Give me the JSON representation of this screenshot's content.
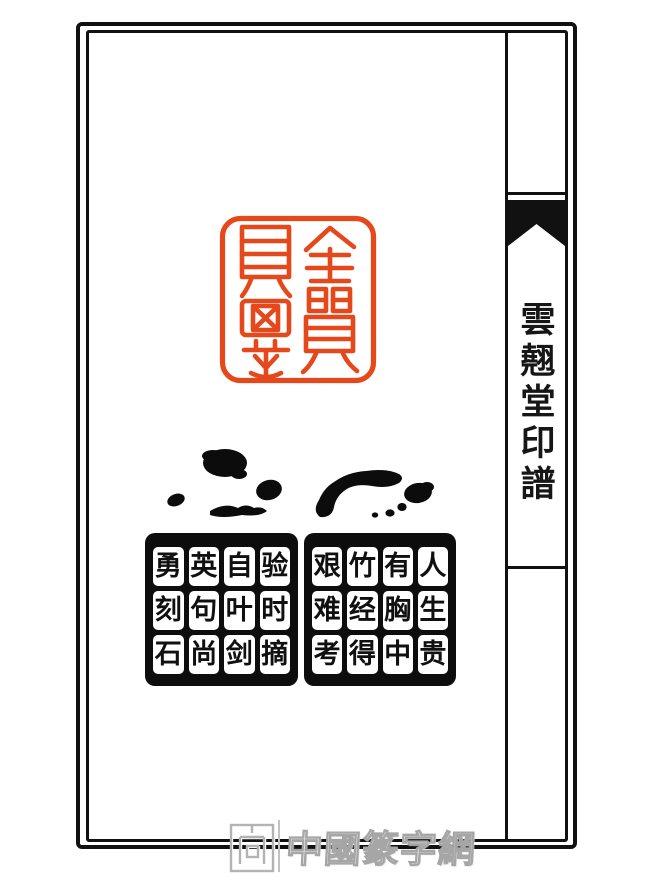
{
  "page": {
    "background": "#ffffff",
    "frame_color": "#111111"
  },
  "spine": {
    "title": "雲翹堂印譜"
  },
  "red_seal": {
    "color": "#e5491b",
    "style": "seal-script impression, two columns, rounded square border"
  },
  "black_seals": {
    "ink_color": "#0d0d0d",
    "left": {
      "cells": [
        "勇",
        "英",
        "自",
        "验",
        "刻",
        "句",
        "叶",
        "时",
        "石",
        "尚",
        "剑",
        "摘"
      ]
    },
    "right": {
      "cells": [
        "艰",
        "竹",
        "有",
        "人",
        "难",
        "经",
        "胸",
        "生",
        "考",
        "得",
        "中",
        "贵"
      ]
    }
  },
  "watermark": {
    "text": "中國篆字網",
    "color": "#b3b3b3"
  }
}
